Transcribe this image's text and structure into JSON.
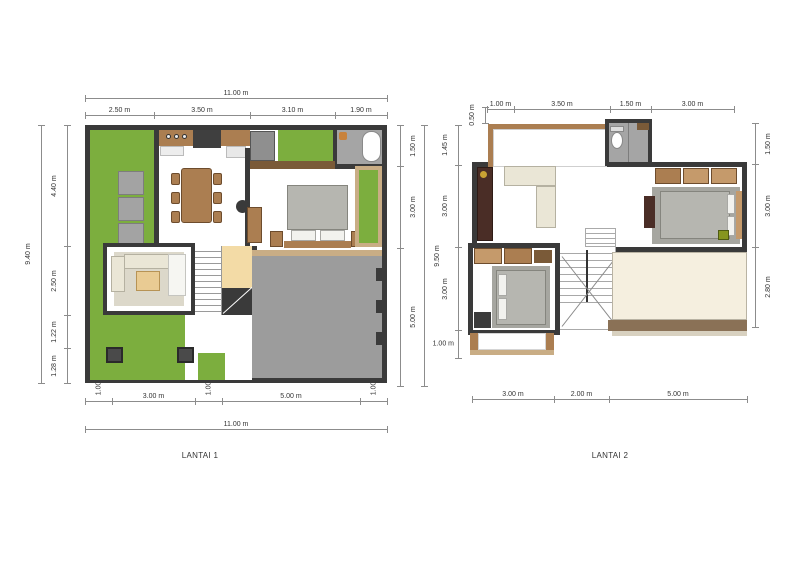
{
  "drawing": {
    "type": "house-floor-plan",
    "background": "#ffffff"
  },
  "colors": {
    "wall": "#3a3a3a",
    "grass": "#7cae3e",
    "concrete": "#9c9c9c",
    "wood": "#ab7e51",
    "wood_dark": "#7a5a38",
    "tan": "#c9ad85",
    "cream": "#eae6d6",
    "rug_gray": "#a6a6a0",
    "rug_beige": "#dcd8ca",
    "bed_gray": "#b6b6b0",
    "bath_gray": "#a5a5a5",
    "cabinet_dark": "#4a2d26",
    "deck": "#f5efdf",
    "deck_edge": "#8a7156",
    "entry": "#f3dba6",
    "dim_line": "#8c8c8c",
    "dim_text": "#333333"
  },
  "plans": [
    {
      "title": "LANTAI 1",
      "dims": {
        "top_overall": "11.00 m",
        "top_segments": [
          "2.50 m",
          "3.50 m",
          "3.10 m",
          "1.90 m"
        ],
        "left_overall": "9.40 m",
        "left_segments": [
          "4.40 m",
          "2.50 m",
          "1.22 m",
          "1.28 m"
        ],
        "right_overall": "9.50 m",
        "right_segments": [
          "1.50 m",
          "3.00 m",
          "5.00 m"
        ],
        "bottom_overall": "11.00 m",
        "bottom_segments": [
          "1.00 m",
          "3.00 m",
          "1.00 m",
          "5.00 m",
          "1.00 m"
        ]
      }
    },
    {
      "title": "LANTAI 2",
      "dims": {
        "top_offset": "0.50 m",
        "top_segments": [
          "1.00 m",
          "3.50 m",
          "1.50 m",
          "3.00 m"
        ],
        "left_segments": [
          "1.45 m",
          "3.00 m",
          "3.00 m",
          "1.00 m"
        ],
        "right_segments": [
          "1.50 m",
          "3.00 m",
          "2.80 m"
        ],
        "bottom_segments": [
          "3.00 m",
          "2.00 m",
          "5.00 m"
        ]
      }
    }
  ]
}
